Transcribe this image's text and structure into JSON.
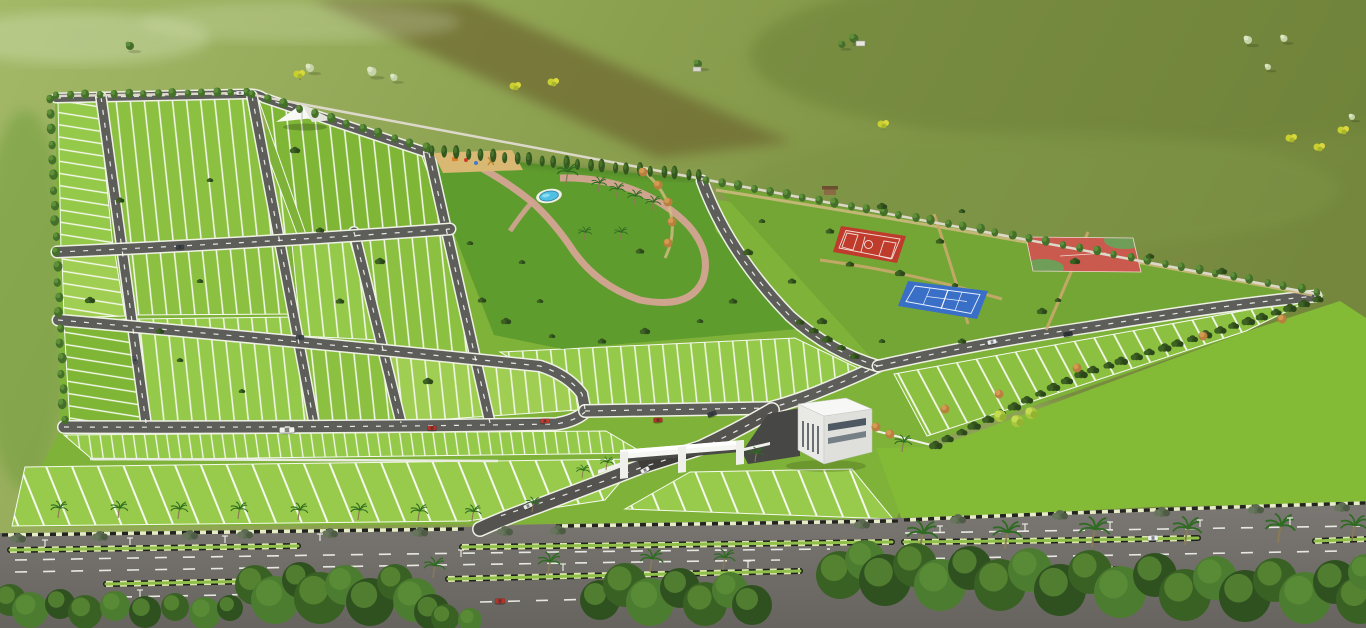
{
  "meta": {
    "type": "3d-aerial-render",
    "subject": "plotted land development township site layout",
    "view": "isometric aerial view",
    "visible_text": "none"
  },
  "palette": {
    "bgL": "#9db55f",
    "bgR": "#74873d",
    "bgBand": "#6f6a33",
    "mist": "#dde8c2",
    "plotLine": "#f6f9ee",
    "road": "#5d5d59",
    "roadCase": "#eef1e4",
    "mainRoadTop": "#7b7874",
    "mainRoadBottom": "#67645f",
    "g1": "#8cc040",
    "g2": "#95c94a",
    "g3": "#7fb636",
    "g4": "#a0ce52",
    "gB": "#98cb4b",
    "lawnOut": "#83bb37",
    "park": "#5f9c2e",
    "sport": "#74a635",
    "pool": "#4fc0e4",
    "path": "#d4a494",
    "sand": "#d9b873",
    "ctRed": "#bf3c2c",
    "ctRed2": "#cb5a4e",
    "ctBlue": "#3a6fc8",
    "ctGreen": "#6f9e58",
    "wall": "#ddd9ca",
    "white": "#f4f4f1",
    "medGreen": "#8fbf4a",
    "treeD": "#2f5120",
    "treeM": "#4c7c30",
    "treeL": "#6ca344"
  },
  "scene": {
    "background": {
      "description": "open farmland in muted olive greens with hazy mist patches, a dark ploughed diagonal strip at top, scattered trees and two tiny farm huts",
      "features": [
        "farmland",
        "ploughed-strip",
        "mist-patches",
        "scattered-trees",
        "farm-huts",
        "yellow-flowering-trees"
      ]
    },
    "site": {
      "boundary": "compound wall lined with trees on north and west, shrub hedge on south-east",
      "plot_blocks": 13,
      "internal_roads": [
        "top-boundary-road",
        "cross-road-1",
        "cross-road-2",
        "cross-road-3",
        "diagonal-road-1",
        "diagonal-road-2",
        "diagonal-road-3",
        "diagonal-road-4",
        "park-edge-road",
        "main-avenue",
        "southeast-perimeter-road",
        "entry-drive"
      ],
      "plots": "narrow green plots divided by white marking lines"
    },
    "park": {
      "elements": [
        "swimming-pool",
        "children-playground",
        "shade-canopy",
        "pink-walkways",
        "palm-trees",
        "ornamental-shrub-arc",
        "lawn"
      ]
    },
    "sports_zone": {
      "courts": [
        {
          "name": "basketball-court",
          "color": "#bf3c2c"
        },
        {
          "name": "tennis-court",
          "color": "#3a6fc8"
        },
        {
          "name": "multipurpose-court",
          "color": "#cb5a4e"
        }
      ],
      "extras": [
        "tan-hedge-rows",
        "gazebo-hut",
        "lawns"
      ]
    },
    "entrance": {
      "elements": [
        "white-entry-gate-portal",
        "clubhouse-building",
        "dark-entry-ramp",
        "white-fence",
        "gate-road"
      ]
    },
    "main_road": {
      "lanes": "multi-lane boulevard",
      "medians": 2,
      "median_style": "green top with black and pale hazard striping",
      "street_lights": true,
      "palm_trees": true,
      "foreground": "dense dark tree canopy along the bottom edge"
    }
  },
  "deco": {
    "tree_rows": [
      {
        "ref": "#btree",
        "name": "top-boundary-tree",
        "x1": 56,
        "y1": 99,
        "x2": 246,
        "y2": 96,
        "n": 13,
        "s": 0.9
      },
      {
        "ref": "#btree",
        "name": "top-boundary-tree",
        "x1": 252,
        "y1": 98,
        "x2": 426,
        "y2": 152,
        "n": 11,
        "s": 0.95
      },
      {
        "ref": "#cyp",
        "name": "park-boundary-tree",
        "x1": 432,
        "y1": 156,
        "x2": 700,
        "y2": 181,
        "n": 22,
        "s": 1
      },
      {
        "ref": "#btree",
        "name": "top-boundary-tree",
        "x1": 706,
        "y1": 184,
        "x2": 1012,
        "y2": 239,
        "n": 19,
        "s": 0.95
      },
      {
        "ref": "#btree",
        "name": "top-boundary-tree",
        "x1": 1012,
        "y1": 239,
        "x2": 1318,
        "y2": 296,
        "n": 18,
        "s": 0.9
      },
      {
        "ref": "#btree",
        "name": "left-boundary-tree",
        "x1": 50,
        "y1": 103,
        "x2": 64,
        "y2": 424,
        "n": 21,
        "s": 1
      },
      {
        "ref": "#shrubD",
        "name": "southeast-boundary-shrub",
        "x1": 1318,
        "y1": 299,
        "x2": 1080,
        "y2": 374,
        "n": 17,
        "s": 1
      },
      {
        "ref": "#shrubD",
        "name": "southeast-boundary-shrub",
        "x1": 1080,
        "y1": 374,
        "x2": 935,
        "y2": 445,
        "n": 11,
        "s": 1
      },
      {
        "ref": "#shrubD",
        "name": "avenue-tree",
        "x1": 800,
        "y1": 322,
        "x2": 855,
        "y2": 356,
        "n": 4,
        "s": 0.8
      }
    ],
    "gray_shrubs": [
      [
        18,
        538
      ],
      [
        100,
        536
      ],
      [
        190,
        535
      ],
      [
        245,
        534
      ],
      [
        330,
        533
      ],
      [
        420,
        532
      ],
      [
        505,
        531
      ],
      [
        558,
        530
      ],
      [
        862,
        524
      ],
      [
        958,
        519
      ],
      [
        1060,
        515
      ],
      [
        1162,
        512
      ],
      [
        1256,
        509
      ],
      [
        1342,
        507
      ]
    ],
    "dark_shrubs": [
      [
        470,
        243
      ],
      [
        482,
        300
      ],
      [
        506,
        321
      ],
      [
        552,
        336
      ],
      [
        602,
        341
      ],
      [
        645,
        331
      ],
      [
        700,
        321
      ],
      [
        733,
        301
      ],
      [
        748,
        252
      ],
      [
        522,
        262
      ],
      [
        850,
        264
      ],
      [
        900,
        273
      ],
      [
        955,
        285
      ],
      [
        940,
        241
      ],
      [
        1075,
        261
      ],
      [
        1058,
        300
      ],
      [
        830,
        231
      ],
      [
        882,
        206
      ],
      [
        962,
        211
      ],
      [
        1150,
        256
      ],
      [
        1222,
        271
      ],
      [
        762,
        221
      ],
      [
        792,
        281
      ],
      [
        822,
        321
      ],
      [
        882,
        341
      ],
      [
        962,
        341
      ],
      [
        1042,
        311
      ],
      [
        200,
        281
      ],
      [
        340,
        301
      ],
      [
        428,
        381
      ],
      [
        242,
        391
      ],
      [
        160,
        331
      ],
      [
        380,
        261
      ],
      [
        540,
        301
      ],
      [
        640,
        251
      ],
      [
        295,
        150
      ],
      [
        210,
        180
      ],
      [
        120,
        200
      ],
      [
        90,
        300
      ],
      [
        180,
        360
      ],
      [
        320,
        230
      ]
    ],
    "orange_bushes": [
      [
        1203,
        336
      ],
      [
        1077,
        368
      ],
      [
        945,
        409
      ],
      [
        1282,
        319
      ],
      [
        999,
        394
      ],
      [
        876,
        427
      ],
      [
        890,
        434
      ],
      [
        643,
        172
      ],
      [
        658,
        185
      ],
      [
        668,
        202
      ],
      [
        672,
        222
      ],
      [
        668,
        243
      ]
    ],
    "yellow_bushes": [
      [
        1000,
        416
      ],
      [
        1017,
        421
      ],
      [
        1031,
        413
      ]
    ],
    "yellow_trees": [
      [
        516,
        92
      ],
      [
        554,
        88
      ],
      [
        1292,
        144
      ],
      [
        1320,
        153
      ],
      [
        1344,
        136
      ],
      [
        884,
        130
      ],
      [
        300,
        80
      ]
    ],
    "bg_trees": [
      {
        "x": 310,
        "y": 72,
        "s": 0.8,
        "c": "pale"
      },
      {
        "x": 372,
        "y": 76,
        "s": 0.9,
        "c": "pale"
      },
      {
        "x": 394,
        "y": 81,
        "s": 0.7,
        "c": "pale"
      },
      {
        "x": 1248,
        "y": 44,
        "s": 0.8,
        "c": "pale"
      },
      {
        "x": 1284,
        "y": 42,
        "s": 0.7,
        "c": "pale"
      },
      {
        "x": 1268,
        "y": 70,
        "s": 0.6,
        "c": "pale"
      },
      {
        "x": 1352,
        "y": 120,
        "s": 0.6,
        "c": "pale"
      },
      {
        "x": 160,
        "y": 162,
        "s": 1.2,
        "c": "dark"
      },
      {
        "x": 175,
        "y": 157,
        "s": 0.9,
        "c": "dark"
      },
      {
        "x": 130,
        "y": 50,
        "s": 0.8,
        "c": "dark"
      },
      {
        "x": 854,
        "y": 43,
        "s": 0.9,
        "c": "dark"
      },
      {
        "x": 842,
        "y": 48,
        "s": 0.7,
        "c": "dark"
      },
      {
        "x": 698,
        "y": 68,
        "s": 0.8,
        "c": "dark"
      }
    ],
    "palms": [
      [
        566,
        184,
        1.1
      ],
      [
        598,
        192,
        0.8
      ],
      [
        616,
        198,
        0.8
      ],
      [
        634,
        205,
        0.8
      ],
      [
        652,
        211,
        0.8
      ],
      [
        584,
        240,
        0.7
      ],
      [
        620,
        240,
        0.7
      ],
      [
        58,
        518,
        0.9
      ],
      [
        118,
        518,
        0.9
      ],
      [
        178,
        519,
        0.9
      ],
      [
        238,
        519,
        0.9
      ],
      [
        298,
        520,
        0.9
      ],
      [
        358,
        520,
        0.9
      ],
      [
        418,
        521,
        0.9
      ],
      [
        472,
        521,
        0.85
      ],
      [
        532,
        512,
        0.8
      ],
      [
        582,
        478,
        0.7
      ],
      [
        606,
        470,
        0.7
      ],
      [
        920,
        551,
        1.6
      ],
      [
        1005,
        549,
        1.5
      ],
      [
        1092,
        547,
        1.6
      ],
      [
        1185,
        545,
        1.5
      ],
      [
        1278,
        543,
        1.55
      ],
      [
        1352,
        541,
        1.4
      ],
      [
        433,
        578,
        1.1
      ],
      [
        548,
        575,
        1.2
      ],
      [
        650,
        572,
        1.2
      ],
      [
        723,
        570,
        1.1
      ],
      [
        755,
        462,
        0.8
      ],
      [
        902,
        452,
        0.9
      ]
    ],
    "lights": [
      [
        45,
        547
      ],
      [
        130,
        545
      ],
      [
        225,
        543
      ],
      [
        320,
        541
      ],
      [
        461,
        557
      ],
      [
        563,
        571
      ],
      [
        748,
        568
      ],
      [
        940,
        533
      ],
      [
        1025,
        531
      ],
      [
        1110,
        529
      ],
      [
        1200,
        527
      ],
      [
        1290,
        525
      ],
      [
        262,
        575
      ],
      [
        140,
        597
      ],
      [
        240,
        594
      ]
    ],
    "forest": [
      [
        10,
        600,
        16
      ],
      [
        30,
        610,
        18
      ],
      [
        60,
        604,
        15
      ],
      [
        85,
        612,
        17
      ],
      [
        115,
        606,
        15
      ],
      [
        145,
        612,
        16
      ],
      [
        175,
        607,
        14
      ],
      [
        205,
        613,
        16
      ],
      [
        230,
        608,
        13
      ],
      [
        255,
        585,
        20
      ],
      [
        275,
        600,
        24
      ],
      [
        300,
        580,
        18
      ],
      [
        320,
        598,
        26
      ],
      [
        345,
        585,
        20
      ],
      [
        370,
        602,
        24
      ],
      [
        395,
        582,
        18
      ],
      [
        415,
        600,
        22
      ],
      [
        432,
        612,
        18
      ],
      [
        445,
        618,
        14
      ],
      [
        470,
        620,
        12
      ],
      [
        600,
        600,
        20
      ],
      [
        625,
        585,
        22
      ],
      [
        650,
        602,
        24
      ],
      [
        680,
        588,
        20
      ],
      [
        705,
        604,
        22
      ],
      [
        730,
        590,
        18
      ],
      [
        752,
        605,
        20
      ],
      [
        840,
        575,
        24
      ],
      [
        865,
        560,
        20
      ],
      [
        885,
        580,
        26
      ],
      [
        915,
        565,
        22
      ],
      [
        940,
        585,
        26
      ],
      [
        970,
        568,
        22
      ],
      [
        1000,
        585,
        26
      ],
      [
        1030,
        570,
        22
      ],
      [
        1060,
        590,
        26
      ],
      [
        1090,
        572,
        22
      ],
      [
        1120,
        592,
        26
      ],
      [
        1155,
        575,
        22
      ],
      [
        1185,
        595,
        26
      ],
      [
        1215,
        578,
        22
      ],
      [
        1245,
        596,
        26
      ],
      [
        1275,
        580,
        22
      ],
      [
        1305,
        598,
        26
      ],
      [
        1335,
        582,
        22
      ],
      [
        1360,
        600,
        24
      ],
      [
        1366,
        572,
        18
      ]
    ],
    "forest_colors": [
      "#3a6124",
      "#4c7c30",
      "#2f5120"
    ],
    "forest_highlight": "#5f9038"
  },
  "vehicles": [
    {
      "x": 287,
      "y": 430,
      "a": -1,
      "w": 15,
      "h": 5.5,
      "c": "#f2f2ee",
      "name": "white-bus"
    },
    {
      "x": 432,
      "y": 428,
      "a": -1,
      "w": 9,
      "h": 4.5,
      "c": "#b33326",
      "name": "red-car"
    },
    {
      "x": 545,
      "y": 421,
      "a": -2,
      "w": 9,
      "h": 4.5,
      "c": "#c23a2c",
      "name": "red-car"
    },
    {
      "x": 658,
      "y": 420,
      "a": -3,
      "w": 9,
      "h": 4.5,
      "c": "#b03126",
      "name": "red-car"
    },
    {
      "x": 712,
      "y": 414,
      "a": -20,
      "w": 9,
      "h": 4.5,
      "c": "#3a3f44",
      "name": "dark-car"
    },
    {
      "x": 180,
      "y": 247,
      "a": -2,
      "w": 8,
      "h": 4,
      "c": "#3c4248",
      "name": "dark-car"
    },
    {
      "x": 300,
      "y": 337,
      "a": 3,
      "w": 8,
      "h": 4,
      "c": "#454a50",
      "name": "dark-car"
    },
    {
      "x": 240,
      "y": 93,
      "a": 0,
      "w": 8,
      "h": 4,
      "c": "#e8e8e4",
      "name": "white-car"
    },
    {
      "x": 135,
      "y": 360,
      "a": 82,
      "w": 8,
      "h": 4,
      "c": "#50555a",
      "name": "dark-car"
    },
    {
      "x": 992,
      "y": 342,
      "a": -12,
      "w": 9,
      "h": 4.5,
      "c": "#eceff0",
      "name": "white-car"
    },
    {
      "x": 1068,
      "y": 334,
      "a": -10,
      "w": 9,
      "h": 4.5,
      "c": "#2f3338",
      "name": "dark-car"
    },
    {
      "x": 645,
      "y": 470,
      "a": -28,
      "w": 9,
      "h": 4.5,
      "c": "#f0f0ec",
      "name": "white-car"
    },
    {
      "x": 528,
      "y": 506,
      "a": -25,
      "w": 9,
      "h": 4.5,
      "c": "#e9e9e6",
      "name": "white-car"
    },
    {
      "x": 920,
      "y": 551,
      "a": -2,
      "w": 10,
      "h": 5,
      "c": "#c03a2e",
      "name": "red-car"
    },
    {
      "x": 1153,
      "y": 538,
      "a": -2,
      "w": 10,
      "h": 5,
      "c": "#eef0f0",
      "name": "white-car"
    },
    {
      "x": 500,
      "y": 601,
      "a": -2,
      "w": 10,
      "h": 5,
      "c": "#b5352a",
      "name": "red-car"
    },
    {
      "x": 935,
      "y": 565,
      "a": -2,
      "w": 10,
      "h": 5,
      "c": "#30353a",
      "name": "dark-suv"
    }
  ]
}
